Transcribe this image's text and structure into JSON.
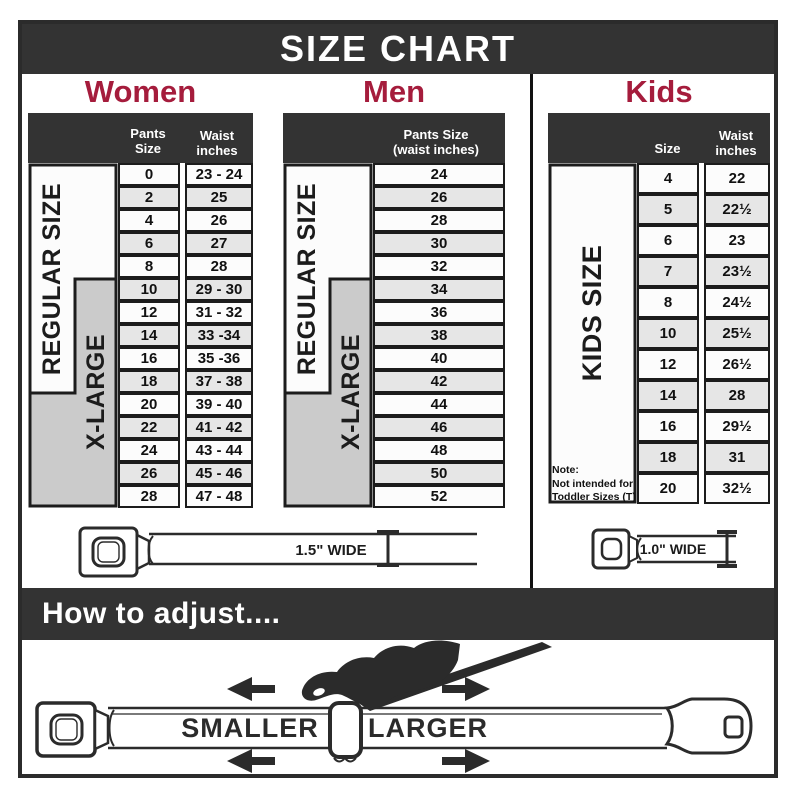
{
  "title": "SIZE CHART",
  "colors": {
    "accent_red": "#a51c3c",
    "band_dark": "#333333",
    "border_dark": "#1c1c1c",
    "row_alt_gray": "#e6e6e6",
    "xlarge_gray": "#cbcbcb"
  },
  "labels": {
    "regular_size": "REGULAR SIZE",
    "x_large": "X-LARGE",
    "kids_size": "KIDS SIZE"
  },
  "tables": {
    "women": {
      "heading": "Women",
      "col1_header": "Pants Size",
      "col2_header_line1": "Waist",
      "col2_header_line2": "inches",
      "rows": [
        {
          "size": "0",
          "waist": "23 - 24"
        },
        {
          "size": "2",
          "waist": "25"
        },
        {
          "size": "4",
          "waist": "26"
        },
        {
          "size": "6",
          "waist": "27"
        },
        {
          "size": "8",
          "waist": "28"
        },
        {
          "size": "10",
          "waist": "29 - 30"
        },
        {
          "size": "12",
          "waist": "31 - 32"
        },
        {
          "size": "14",
          "waist": "33 -34"
        },
        {
          "size": "16",
          "waist": "35 -36"
        },
        {
          "size": "18",
          "waist": "37 - 38"
        },
        {
          "size": "20",
          "waist": "39 - 40"
        },
        {
          "size": "22",
          "waist": "41 - 42"
        },
        {
          "size": "24",
          "waist": "43 - 44"
        },
        {
          "size": "26",
          "waist": "45 - 46"
        },
        {
          "size": "28",
          "waist": "47 - 48"
        }
      ]
    },
    "men": {
      "heading": "Men",
      "col_header_line1": "Pants Size",
      "col_header_line2": "(waist inches)",
      "rows": [
        "24",
        "26",
        "28",
        "30",
        "32",
        "34",
        "36",
        "38",
        "40",
        "42",
        "44",
        "46",
        "48",
        "50",
        "52"
      ]
    },
    "kids": {
      "heading": "Kids",
      "col1_header": "Size",
      "col2_header_line1": "Waist",
      "col2_header_line2": "inches",
      "note_lines": [
        "Note:",
        "Not intended for",
        "Toddler Sizes (T)"
      ],
      "rows": [
        {
          "size": "4",
          "waist": "22"
        },
        {
          "size": "5",
          "waist": "22½"
        },
        {
          "size": "6",
          "waist": "23"
        },
        {
          "size": "7",
          "waist": "23½"
        },
        {
          "size": "8",
          "waist": "24½"
        },
        {
          "size": "10",
          "waist": "25½"
        },
        {
          "size": "12",
          "waist": "26½"
        },
        {
          "size": "14",
          "waist": "28"
        },
        {
          "size": "16",
          "waist": "29½"
        },
        {
          "size": "18",
          "waist": "31"
        },
        {
          "size": "20",
          "waist": "32½"
        }
      ]
    }
  },
  "belts": {
    "adult": {
      "width_label": "1.5\" WIDE"
    },
    "kids": {
      "width_label": "1.0\" WIDE"
    }
  },
  "adjust": {
    "heading": "How to adjust....",
    "smaller": "SMALLER",
    "larger": "LARGER"
  }
}
